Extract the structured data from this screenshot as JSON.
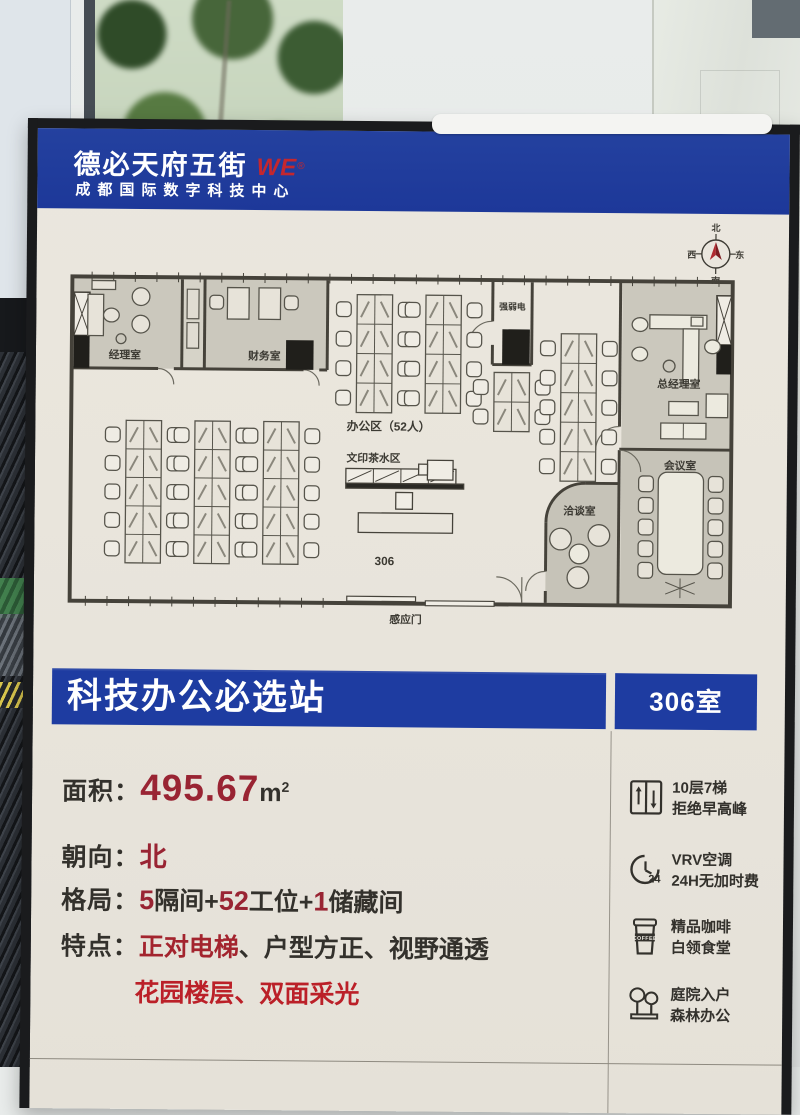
{
  "header": {
    "brand": "德必天府五街",
    "brand_mark": "WE",
    "brand_mark_sup": "®",
    "subtitle": "成都国际数字科技中心"
  },
  "compass": {
    "n": "北",
    "e": "东",
    "s": "南",
    "w": "西"
  },
  "floorplan": {
    "manager_room": "经理室",
    "finance_room": "财务室",
    "office_area": "办公区（52人）",
    "utility_room": "强弱电",
    "gm_room": "总经理室",
    "print_tea_area": "文印茶水区",
    "negotiation_room": "洽谈室",
    "meeting_room": "会议室",
    "room_number": "306",
    "sensor_door": "感应门"
  },
  "banner": {
    "title": "科技办公必选站",
    "room_no": "306室"
  },
  "specs": {
    "area": {
      "label": "面积：",
      "value": "495.67",
      "unit": "m",
      "unit_sup": "2"
    },
    "orientation": {
      "label": "朝向：",
      "value": "北"
    },
    "layout": {
      "label": "格局：",
      "n1": "5",
      "t1": "隔间+",
      "n2": "52",
      "t2": "工位+",
      "n3": "1",
      "t3": "储藏间"
    },
    "features": {
      "label": "特点：",
      "f1": "正对电梯",
      "sep1": "、",
      "f2": "户型方正",
      "sep2": "、",
      "f3": "视野通透",
      "f4": "花园楼层",
      "sep3": "、",
      "f5": "双面采光"
    }
  },
  "amenities": [
    {
      "icon": "elevator-icon",
      "line1": "10层7梯",
      "line2": "拒绝早高峰",
      "icon_text": ""
    },
    {
      "icon": "clock-24-icon",
      "line1": "VRV空调",
      "line2": "24H无加时费",
      "icon_text": "24"
    },
    {
      "icon": "coffee-icon",
      "line1": "精品咖啡",
      "line2": "白领食堂",
      "icon_text": "COFFEE"
    },
    {
      "icon": "trees-icon",
      "line1": "庭院入户",
      "line2": "森林办公",
      "icon_text": ""
    }
  ],
  "colors": {
    "brand_blue": "#1e3ca1",
    "accent_red": "#992433",
    "bright_red": "#bb2028",
    "poster_cream": "#e9e5dc",
    "ink": "#33312c"
  }
}
